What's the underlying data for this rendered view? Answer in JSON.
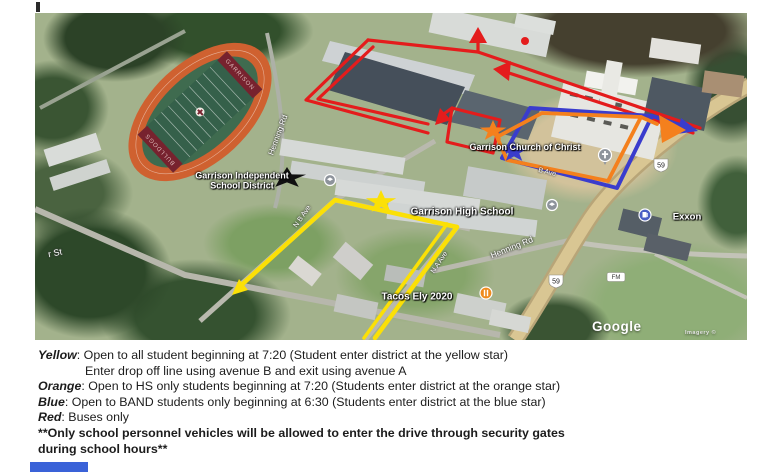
{
  "map": {
    "places": {
      "district_line1": "Garrison Independent",
      "district_line2": "School District",
      "church": "Garrison Church of Christ",
      "high_school": "Garrison High School",
      "gas_station": "Exxon",
      "restaurant": "Tacos Ely 2020"
    },
    "streets": {
      "henning_rd": "Henning Rd",
      "henning_rd_upper": "Henning Rd",
      "partial_street": "r St",
      "ave_b": "N B Ave",
      "ave_a": "N A Ave",
      "ave_b_short": "B Ave"
    },
    "shields": {
      "highway": "59",
      "fm": "FM"
    },
    "field": {
      "top_endzone": "GARRISON",
      "bottom_endzone": "BULLDOGS"
    },
    "attribution": {
      "brand": "Google",
      "imagery": "Imagery ©"
    },
    "route_colors": {
      "yellow": "#fbe006",
      "orange": "#f4801d",
      "blue": "#3a3ccd",
      "red": "#e41c1c",
      "black_star": "#111111"
    }
  },
  "legend": {
    "lines": [
      {
        "lead": "Yellow",
        "rest": ": Open to all student beginning at 7:20 (Student enter district at the yellow star)"
      },
      {
        "lead": "",
        "rest": "Enter drop off line using avenue B and exit using avenue A"
      },
      {
        "lead": "Orange",
        "rest": ": Open to HS only students beginning at 7:20 (Students enter district at the orange star)"
      },
      {
        "lead": "Blue",
        "rest": ": Open to BAND students only beginning at 6:30 (Students enter district at the blue star)"
      },
      {
        "lead": "Red",
        "rest": ": Buses only"
      }
    ],
    "note_line1": "**Only school personnel vehicles will be allowed to enter the drive through security gates",
    "note_line2": "during school hours**"
  }
}
